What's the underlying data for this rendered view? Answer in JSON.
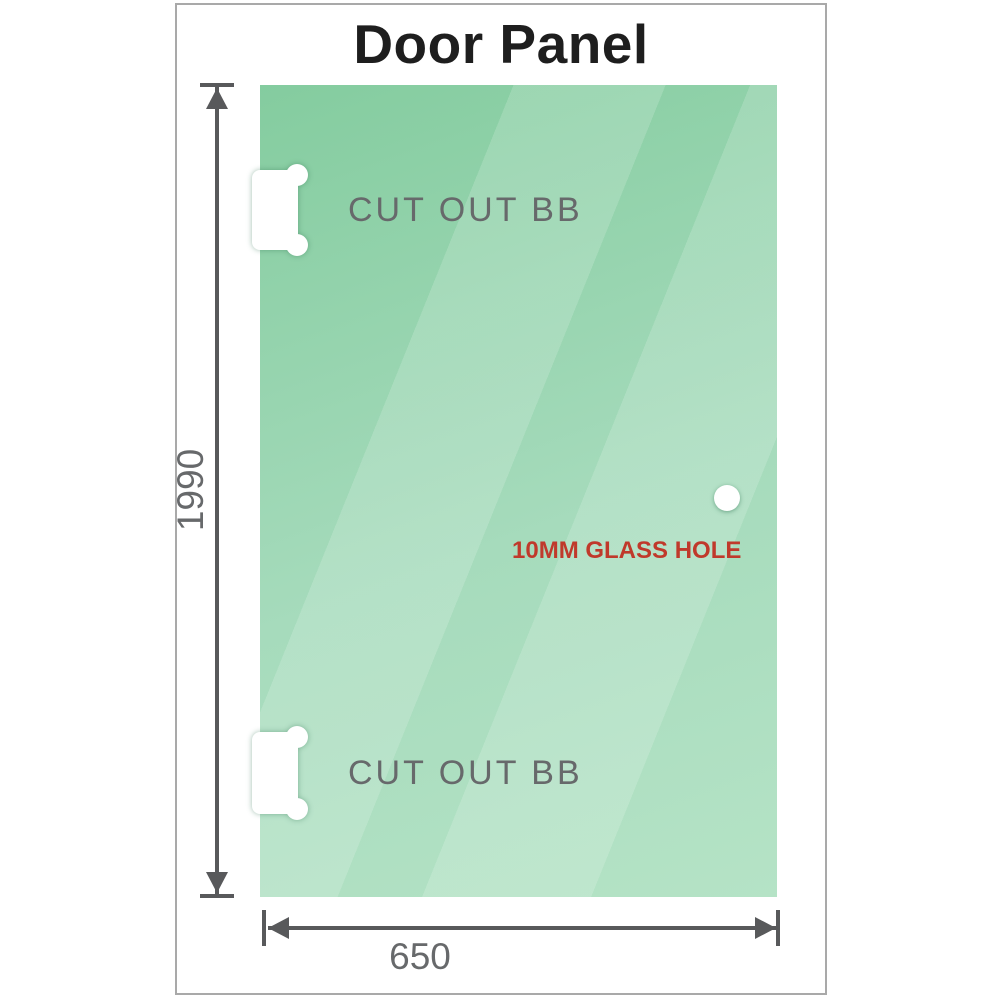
{
  "title": "Door Panel",
  "panel": {
    "cutout_labels": [
      "CUT OUT BB",
      "CUT OUT BB"
    ],
    "glass_hole_label": "10MM GLASS HOLE"
  },
  "dimensions": {
    "height": "1990",
    "width": "650"
  },
  "colors": {
    "title_color": "#1e1e1e",
    "frame_border": "#a9a9a9",
    "glass_base": "#84cc9f",
    "glass_mid": "#a6dbbc",
    "glass_light": "#b5e3c6",
    "dimension": "#58595b",
    "label_gray": "#67696b",
    "hole_label_red": "#c0392b"
  }
}
